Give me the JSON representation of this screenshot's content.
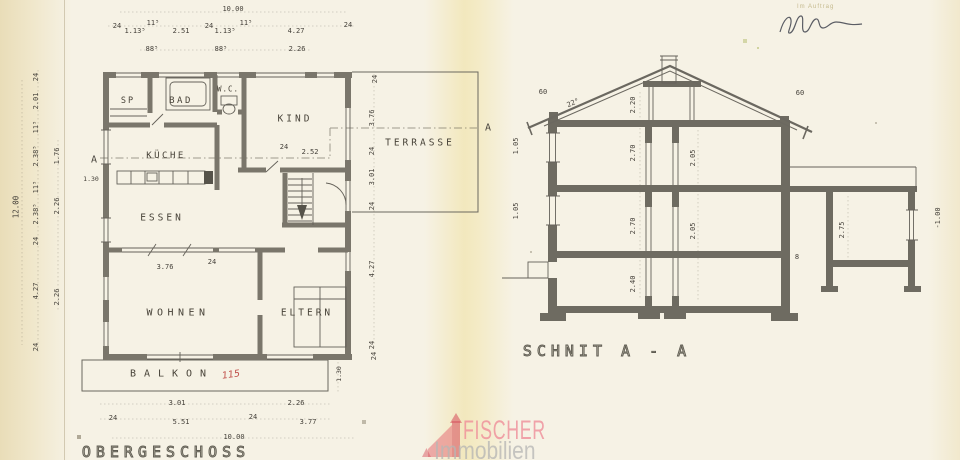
{
  "watermark": {
    "brand": "FISCHER",
    "subtitle": "Immobilien"
  },
  "stamp": {
    "label": "Im Auftrag"
  },
  "plan": {
    "title": {
      "id": "plan-title",
      "text": "OBERGESCHOSS",
      "x": 166,
      "y": 452,
      "size": 15
    },
    "room_labels": [
      {
        "id": "room-sp",
        "text": "SP",
        "x": 128,
        "y": 101,
        "size": 8.5,
        "ls": 2
      },
      {
        "id": "room-bad",
        "text": "BAD",
        "x": 181,
        "y": 101,
        "size": 9,
        "ls": 2.5
      },
      {
        "id": "room-wc",
        "text": "W.C.",
        "x": 228,
        "y": 89,
        "size": 7.5,
        "ls": 1
      },
      {
        "id": "room-kind",
        "text": "KIND",
        "x": 295,
        "y": 119,
        "size": 9.5,
        "ls": 3
      },
      {
        "id": "room-kueche",
        "text": "KÜCHE",
        "x": 166,
        "y": 156,
        "size": 9,
        "ls": 2.5
      },
      {
        "id": "room-essen",
        "text": "ESSEN",
        "x": 162,
        "y": 218,
        "size": 9.5,
        "ls": 3
      },
      {
        "id": "room-wohnen",
        "text": "WOHNEN",
        "x": 178,
        "y": 313,
        "size": 10,
        "ls": 4.5
      },
      {
        "id": "room-eltern",
        "text": "ELTERN",
        "x": 307,
        "y": 313,
        "size": 9.5,
        "ls": 3
      },
      {
        "id": "room-terrasse",
        "text": "TERRASSE",
        "x": 420,
        "y": 143,
        "size": 9.5,
        "ls": 3
      },
      {
        "id": "room-balkon",
        "text": "BALKON",
        "x": 172,
        "y": 374,
        "size": 10,
        "ls": 8
      }
    ],
    "dim_labels": [
      {
        "id": "dim-plan-width-top",
        "text": "10.00",
        "x": 233,
        "y": 9
      },
      {
        "id": "dim-t1",
        "text": "24",
        "x": 117,
        "y": 26
      },
      {
        "id": "dim-t2",
        "text": "1.13⁵",
        "x": 135,
        "y": 31
      },
      {
        "id": "dim-t3",
        "text": "11⁵",
        "x": 153,
        "y": 23
      },
      {
        "id": "dim-t4",
        "text": "2.51",
        "x": 181,
        "y": 31
      },
      {
        "id": "dim-t5",
        "text": "24",
        "x": 209,
        "y": 26
      },
      {
        "id": "dim-t6",
        "text": "1.13⁵",
        "x": 225,
        "y": 31
      },
      {
        "id": "dim-t7",
        "text": "11⁵",
        "x": 246,
        "y": 23
      },
      {
        "id": "dim-t8",
        "text": "4.27",
        "x": 296,
        "y": 31
      },
      {
        "id": "dim-t9",
        "text": "24",
        "x": 348,
        "y": 25
      },
      {
        "id": "dim-t10",
        "text": "88⁵",
        "x": 152,
        "y": 49
      },
      {
        "id": "dim-t11",
        "text": "88⁵",
        "x": 221,
        "y": 49
      },
      {
        "id": "dim-t12",
        "text": "2.26",
        "x": 297,
        "y": 49
      },
      {
        "id": "dim-r0",
        "text": "24",
        "x": 375,
        "y": 79,
        "rot": -90
      },
      {
        "id": "dim-plan-height-left",
        "text": "12.00",
        "x": 16,
        "y": 207,
        "rot": -90,
        "size": 7.5
      },
      {
        "id": "dim-l1",
        "text": "24",
        "x": 36,
        "y": 77,
        "rot": -90
      },
      {
        "id": "dim-l2",
        "text": "2.01",
        "x": 36,
        "y": 101,
        "rot": -90
      },
      {
        "id": "dim-l3",
        "text": "11⁵",
        "x": 36,
        "y": 127,
        "rot": -90
      },
      {
        "id": "dim-l4",
        "text": "2.38⁵",
        "x": 36,
        "y": 156,
        "rot": -90
      },
      {
        "id": "dim-l5",
        "text": "11⁵",
        "x": 36,
        "y": 187,
        "rot": -90
      },
      {
        "id": "dim-l6",
        "text": "2.38⁵",
        "x": 36,
        "y": 214,
        "rot": -90
      },
      {
        "id": "dim-l7",
        "text": "24",
        "x": 36,
        "y": 241,
        "rot": -90
      },
      {
        "id": "dim-l8",
        "text": "4.27",
        "x": 36,
        "y": 291,
        "rot": -90
      },
      {
        "id": "dim-l9",
        "text": "24",
        "x": 36,
        "y": 347,
        "rot": -90
      },
      {
        "id": "dim-l10",
        "text": "1.76",
        "x": 57,
        "y": 156,
        "rot": -90
      },
      {
        "id": "dim-l11",
        "text": "2.26",
        "x": 57,
        "y": 206,
        "rot": -90
      },
      {
        "id": "dim-l12",
        "text": "2.26",
        "x": 57,
        "y": 297,
        "rot": -90
      },
      {
        "id": "dim-kueche-entry",
        "text": "1.30",
        "x": 91,
        "y": 179,
        "size": 6.5
      },
      {
        "id": "dim-rr1",
        "text": "3.76",
        "x": 372,
        "y": 118,
        "rot": -90
      },
      {
        "id": "dim-rr2",
        "text": "24",
        "x": 372,
        "y": 151,
        "rot": -90
      },
      {
        "id": "dim-rr3",
        "text": "3.01",
        "x": 372,
        "y": 177,
        "rot": -90
      },
      {
        "id": "dim-rr4",
        "text": "24",
        "x": 372,
        "y": 206,
        "rot": -90
      },
      {
        "id": "dim-rr5",
        "text": "4.27",
        "x": 372,
        "y": 269,
        "rot": -90
      },
      {
        "id": "dim-rr6",
        "text": "24",
        "x": 372,
        "y": 345,
        "rot": -90
      },
      {
        "id": "dim-kind-1",
        "text": "24",
        "x": 284,
        "y": 147
      },
      {
        "id": "dim-kind-2",
        "text": "2.52",
        "x": 310,
        "y": 152
      },
      {
        "id": "dim-wohnen-1",
        "text": "3.76",
        "x": 165,
        "y": 267
      },
      {
        "id": "dim-wohnen-2",
        "text": "24",
        "x": 212,
        "y": 262
      },
      {
        "id": "dim-balkon-depth",
        "text": "1.30",
        "x": 339,
        "y": 374,
        "rot": -90,
        "size": 6.5
      },
      {
        "id": "dim-balkon-24",
        "text": "24",
        "x": 374,
        "y": 356,
        "rot": -90
      },
      {
        "id": "dim-b1",
        "text": "3.01",
        "x": 177,
        "y": 403
      },
      {
        "id": "dim-b2",
        "text": "2.26",
        "x": 296,
        "y": 403
      },
      {
        "id": "dim-b3",
        "text": "24",
        "x": 113,
        "y": 418
      },
      {
        "id": "dim-b4",
        "text": "5.51",
        "x": 181,
        "y": 422
      },
      {
        "id": "dim-b5",
        "text": "24",
        "x": 253,
        "y": 417
      },
      {
        "id": "dim-b6",
        "text": "3.77",
        "x": 308,
        "y": 422
      },
      {
        "id": "dim-plan-width-bottom",
        "text": "10.00",
        "x": 234,
        "y": 437
      }
    ],
    "annotations": [
      {
        "id": "section-marker-left",
        "text": "A",
        "x": 94,
        "y": 160,
        "size": 10
      },
      {
        "id": "section-marker-right",
        "text": "A",
        "x": 488,
        "y": 128,
        "size": 10
      },
      {
        "id": "handwritten-115",
        "text": "115",
        "x": 231,
        "y": 375,
        "size": 9.5,
        "cls": "red",
        "rot": -8
      }
    ]
  },
  "section": {
    "title": {
      "id": "section-title",
      "text": "SCHNIT A - A",
      "x": 607,
      "y": 351,
      "size": 15
    },
    "dim_labels": [
      {
        "id": "dim-s-eave-left",
        "text": "60",
        "x": 543,
        "y": 92
      },
      {
        "id": "dim-s-roof-pitch",
        "text": "22°",
        "x": 573,
        "y": 103,
        "rot": -23
      },
      {
        "id": "dim-s-attic",
        "text": "2.20",
        "x": 633,
        "y": 105,
        "rot": -90
      },
      {
        "id": "dim-s-eave-right",
        "text": "60",
        "x": 800,
        "y": 93
      },
      {
        "id": "dim-s-sill-1",
        "text": "1.05",
        "x": 516,
        "y": 146,
        "rot": -90
      },
      {
        "id": "dim-s-sill-2",
        "text": "1.05",
        "x": 516,
        "y": 211,
        "rot": -90
      },
      {
        "id": "dim-s-og",
        "text": "2.70",
        "x": 633,
        "y": 153,
        "rot": -90
      },
      {
        "id": "dim-s-og-door",
        "text": "2.05",
        "x": 693,
        "y": 158,
        "rot": -90
      },
      {
        "id": "dim-s-eg",
        "text": "2.70",
        "x": 633,
        "y": 226,
        "rot": -90
      },
      {
        "id": "dim-s-eg-door",
        "text": "2.05",
        "x": 693,
        "y": 231,
        "rot": -90
      },
      {
        "id": "dim-s-kg",
        "text": "2.40",
        "x": 633,
        "y": 284,
        "rot": -90
      },
      {
        "id": "dim-s-garage",
        "text": "2.75",
        "x": 842,
        "y": 230,
        "rot": -90
      },
      {
        "id": "dim-s-slab",
        "text": "8",
        "x": 797,
        "y": 257
      },
      {
        "id": "dim-s-garage-level",
        "text": "-1.00",
        "x": 938,
        "y": 218,
        "rot": -90
      }
    ]
  }
}
